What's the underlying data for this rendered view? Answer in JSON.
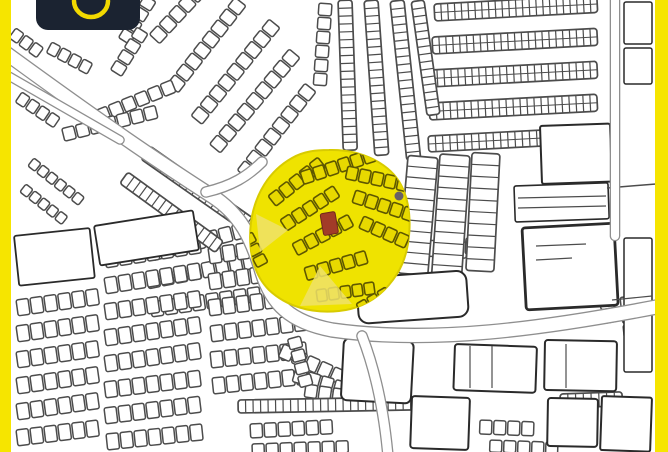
{
  "colors": {
    "bar_yellow": "#f6e500",
    "map_bg": "#ffffff",
    "ink": "#4c4c4c",
    "ink_dark": "#2a2a2a",
    "road_casing": "#8f8f8f",
    "highlight_yellow": "#efe300",
    "blob_edge": "#d8cb00",
    "fan_stroke": "#5e5700",
    "fan_fill": "#e8d900",
    "wedge": "#eee26a",
    "marker_red": "#a23b28",
    "purple_dot": "#595273",
    "logo_bg": "#1b2331",
    "logo_yellow": "#f2d900"
  },
  "logo": {
    "text": "SAKAN"
  },
  "map": {
    "chains": [
      [
        246,
        6,
        128,
        8,
        12,
        14
      ],
      [
        280,
        28,
        129,
        9,
        12,
        14
      ],
      [
        300,
        58,
        130,
        9,
        12,
        14
      ],
      [
        316,
        92,
        128,
        8,
        12,
        14
      ],
      [
        206,
        -6,
        133,
        5,
        12,
        14
      ],
      [
        176,
        92,
        158,
        6,
        12,
        13
      ],
      [
        158,
        118,
        166,
        7,
        12,
        13
      ],
      [
        150,
        246,
        -14,
        8,
        12,
        15
      ],
      [
        146,
        274,
        -11,
        8,
        12,
        15
      ],
      [
        150,
        302,
        -8,
        8,
        12,
        15
      ],
      [
        22,
        92,
        34,
        4,
        10,
        12
      ],
      [
        34,
        158,
        38,
        6,
        9,
        10
      ],
      [
        26,
        184,
        38,
        5,
        9,
        10
      ],
      [
        332,
        4,
        94,
        6,
        12,
        13
      ],
      [
        16,
        300,
        -8,
        6,
        12,
        16
      ],
      [
        16,
        326,
        -8,
        6,
        12,
        16
      ],
      [
        16,
        352,
        -8,
        6,
        12,
        16
      ],
      [
        16,
        378,
        -8,
        6,
        12,
        16
      ],
      [
        16,
        404,
        -8,
        6,
        12,
        16
      ],
      [
        16,
        430,
        -7,
        6,
        12,
        16
      ],
      [
        104,
        252,
        -9,
        7,
        12,
        16
      ],
      [
        104,
        278,
        -9,
        7,
        12,
        16
      ],
      [
        104,
        304,
        -8,
        7,
        12,
        16
      ],
      [
        104,
        330,
        -8,
        7,
        12,
        16
      ],
      [
        104,
        356,
        -8,
        7,
        12,
        16
      ],
      [
        104,
        382,
        -7,
        7,
        12,
        16
      ],
      [
        104,
        408,
        -7,
        7,
        12,
        16
      ],
      [
        106,
        434,
        -6,
        7,
        12,
        16
      ],
      [
        208,
        248,
        -8,
        7,
        12,
        16
      ],
      [
        208,
        274,
        -8,
        7,
        12,
        16
      ],
      [
        208,
        300,
        -7,
        7,
        12,
        16
      ],
      [
        210,
        326,
        -7,
        7,
        12,
        16
      ],
      [
        210,
        352,
        -6,
        7,
        12,
        16
      ],
      [
        212,
        378,
        -6,
        7,
        12,
        16
      ],
      [
        284,
        344,
        24,
        5,
        12,
        14
      ],
      [
        296,
        368,
        16,
        6,
        12,
        14
      ],
      [
        306,
        384,
        8,
        4,
        12,
        13
      ],
      [
        250,
        424,
        -3,
        6,
        12,
        14
      ],
      [
        252,
        444,
        -2,
        7,
        12,
        12
      ],
      [
        480,
        420,
        2,
        4,
        12,
        14
      ],
      [
        490,
        440,
        2,
        5,
        12,
        12
      ],
      [
        620,
        418,
        3,
        2,
        12,
        14
      ],
      [
        608,
        268,
        80,
        4,
        12,
        14
      ],
      [
        634,
        296,
        84,
        3,
        12,
        14
      ],
      [
        424,
        240,
        3,
        3,
        13,
        16
      ],
      [
        466,
        238,
        3,
        2,
        13,
        16
      ],
      [
        356,
        238,
        85,
        2,
        12,
        14
      ],
      [
        300,
        336,
        75,
        4,
        11,
        13
      ],
      [
        52,
        42,
        28,
        4,
        10,
        12
      ],
      [
        156,
        2,
        122,
        4,
        11,
        13
      ],
      [
        148,
        34,
        122,
        4,
        11,
        13
      ],
      [
        16,
        28,
        36,
        3,
        10,
        12
      ]
    ],
    "ladders": [
      [
        434,
        4,
        163,
        17,
        -3,
        24,
        1
      ],
      [
        432,
        37,
        165,
        17,
        -3,
        24,
        1
      ],
      [
        430,
        70,
        167,
        17,
        -3,
        24,
        1
      ],
      [
        429,
        103,
        168,
        17,
        -3,
        24,
        1
      ],
      [
        428,
        136,
        152,
        16,
        -3,
        21,
        1
      ],
      [
        352,
        0,
        150,
        14,
        88,
        19,
        0
      ],
      [
        378,
        0,
        155,
        14,
        86,
        20,
        0
      ],
      [
        404,
        0,
        160,
        14,
        84,
        20,
        0
      ],
      [
        424,
        0,
        115,
        13,
        82,
        15,
        0
      ],
      [
        150,
        146,
        132,
        16,
        35,
        17,
        0
      ],
      [
        128,
        172,
        118,
        14,
        36,
        15,
        0
      ],
      [
        438,
        158,
        118,
        30,
        95,
        11,
        0
      ],
      [
        470,
        156,
        122,
        30,
        94,
        11,
        0
      ],
      [
        500,
        154,
        118,
        28,
        93,
        10,
        0
      ],
      [
        238,
        400,
        180,
        13,
        -1,
        24,
        0
      ],
      [
        560,
        394,
        62,
        14,
        -2,
        8,
        0
      ]
    ],
    "blocks": [
      [
        14,
        236,
        76,
        50,
        -6,
        2,
        1.8
      ],
      [
        94,
        226,
        100,
        40,
        -9,
        2,
        1.8
      ],
      [
        344,
        338,
        70,
        62,
        3,
        6,
        2
      ],
      [
        412,
        396,
        58,
        52,
        2,
        3,
        2
      ],
      [
        548,
        398,
        50,
        48,
        1,
        3,
        2
      ],
      [
        540,
        126,
        70,
        58,
        -2,
        2,
        2
      ],
      [
        514,
        186,
        94,
        36,
        -2,
        2,
        1.6
      ],
      [
        522,
        228,
        92,
        82,
        -3,
        3,
        2.8
      ],
      [
        356,
        278,
        110,
        46,
        -4,
        10,
        2
      ],
      [
        624,
        2,
        28,
        42,
        0,
        2,
        1.5
      ],
      [
        624,
        48,
        28,
        36,
        0,
        2,
        1.5
      ],
      [
        624,
        238,
        28,
        72,
        0,
        2,
        1.5
      ],
      [
        624,
        314,
        28,
        58,
        0,
        2,
        1.5
      ],
      [
        455,
        344,
        82,
        46,
        2,
        3,
        2
      ],
      [
        545,
        340,
        72,
        50,
        1,
        3,
        2
      ],
      [
        602,
        396,
        50,
        54,
        2,
        2,
        2
      ]
    ],
    "lines": [
      [
        607,
        188,
        656,
        184,
        1.5
      ],
      [
        518,
        198,
        606,
        196,
        1.2
      ],
      [
        518,
        208,
        606,
        206,
        1.2
      ],
      [
        470,
        346,
        470,
        388,
        1.2
      ],
      [
        492,
        346,
        492,
        388,
        1.2
      ],
      [
        536,
        246,
        586,
        244,
        1.3
      ],
      [
        536,
        260,
        572,
        258,
        1.2
      ],
      [
        612,
        300,
        652,
        296,
        1.2
      ],
      [
        566,
        344,
        566,
        388,
        1.2
      ]
    ],
    "roads": [
      [
        "M -12 40 C 70 100 140 150 212 196 C 240 214 252 238 262 272 C 272 304 290 322 332 330 C 430 344 540 330 672 304",
        13
      ],
      [
        "M 206 192 C 232 186 248 176 262 162",
        9
      ],
      [
        "M -12 64 C 36 92 78 116 120 140",
        7
      ],
      [
        "M 362 336 C 376 372 384 412 388 456",
        9
      ],
      [
        "M 615 -6 L 615 236",
        8
      ]
    ],
    "blob": "M 329 150 C 360 149 392 163 403 189 C 413 212 412 250 397 274 C 385 293 367 308 339 311 C 311 314 286 306 269 290 C 252 273 248 247 251 222 C 255 194 269 171 292 158 C 304 151 317 150 329 150 Z",
    "fan": [
      [
        268,
        196,
        -38,
        5,
        11,
        13
      ],
      [
        280,
        220,
        -33,
        5,
        11,
        13
      ],
      [
        292,
        244,
        -28,
        5,
        11,
        13
      ],
      [
        300,
        172,
        -18,
        6,
        11,
        13
      ],
      [
        304,
        268,
        -16,
        5,
        11,
        13
      ],
      [
        316,
        290,
        -8,
        5,
        10,
        12
      ],
      [
        348,
        166,
        12,
        5,
        11,
        13
      ],
      [
        356,
        190,
        18,
        5,
        11,
        13
      ],
      [
        364,
        216,
        24,
        4,
        11,
        13
      ],
      [
        356,
        304,
        -30,
        3,
        10,
        12
      ],
      [
        252,
        232,
        62,
        3,
        10,
        12
      ]
    ],
    "wedges": [
      "M 320 266 L 300 306 L 352 304 Z",
      "M 256 214 L 288 230 L 260 252 Z"
    ],
    "marker": [
      320,
      214,
      15,
      22,
      -10
    ],
    "dot": [
      399,
      196,
      4.5
    ]
  }
}
